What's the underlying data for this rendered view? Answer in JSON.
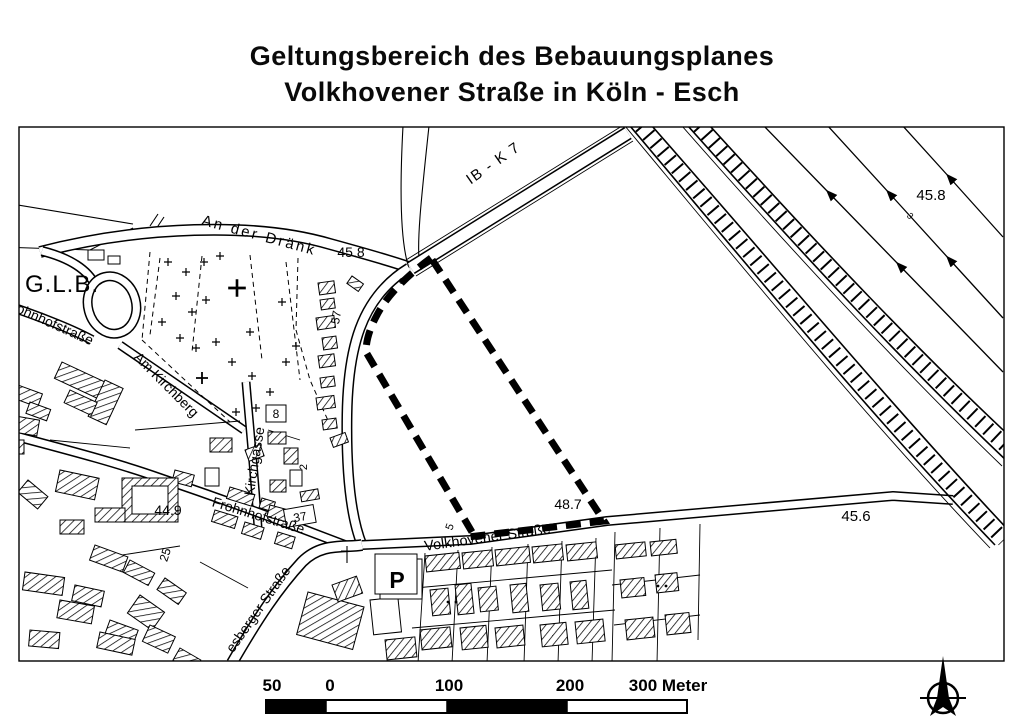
{
  "title": {
    "line1": "Geltungsbereich des Bebauungsplanes",
    "line2": "Volkhovener Straße in Köln - Esch"
  },
  "map": {
    "labels": {
      "an_der_draenk": "An der Dränk",
      "elev_45_8_junction": "45.8",
      "ib_k7": "IB - K 7",
      "elev_45_8_northeast": "45.8",
      "glb": "G.L.B.",
      "frohnhofstrasse_upper": "Frohnhofstraße",
      "am_kirchberg": "Am Kirchberg",
      "kirchgasse": "Kirchgasse",
      "house_no_8": "8",
      "house_no_57": "57",
      "house_no_37": "37",
      "elev_44_9": "44.9",
      "house_no_25": "25",
      "frohnhofstrasse_center": "Frohnhofstraße",
      "esberger_strasse": "esberger Straße",
      "volkhovener_strasse": "Volkhovener Straße",
      "house_no_5": "5",
      "elev_48_7": "48.7",
      "elev_45_6": "45.6",
      "parking": "P",
      "ditch_no_3": "3",
      "house_no_2": "2"
    }
  },
  "scalebar": {
    "labels": [
      "50",
      "0",
      "100",
      "200",
      "300 Meter"
    ]
  },
  "compass": {
    "north": "N"
  }
}
